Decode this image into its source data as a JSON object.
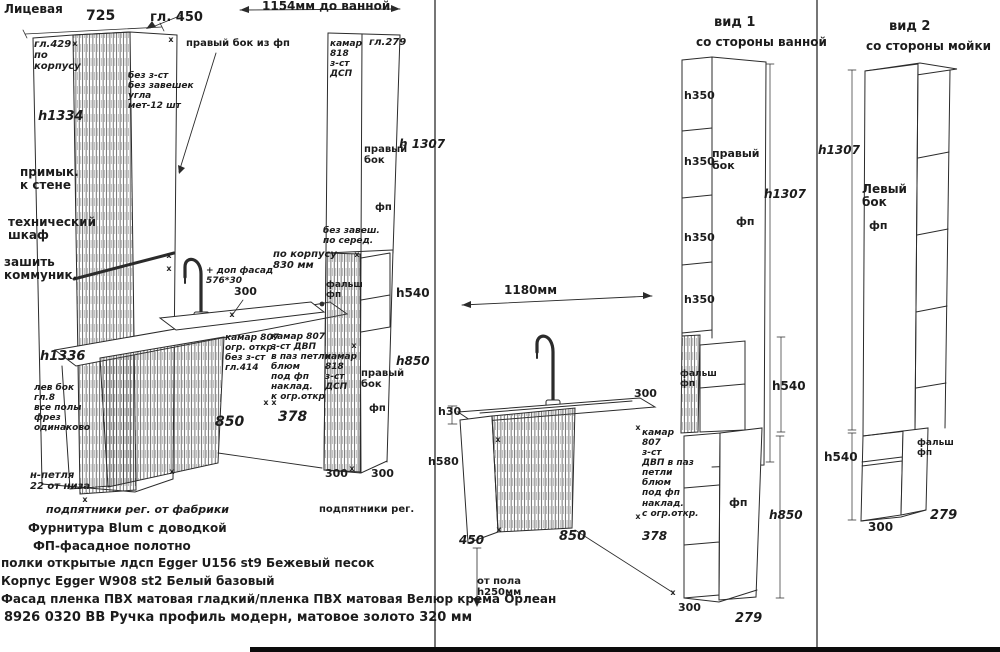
{
  "glyphs": {
    "x": "х"
  },
  "front_view": {
    "title": "Лицевая",
    "dim_width_top": "725",
    "dim_depth_top": "гл. 450",
    "gl429_note": "гл.429\nпо\nкорпусу",
    "h1334": "h1334",
    "no_back_note": "без з-ст\nбез завешек\nугла\nмет-12 шт",
    "right_side_callout": "правый  бок  из фп",
    "wall_note": "примык.\nк стене",
    "tech_note": "технический\nшкаф",
    "comm_note": "зашить\nкоммуник.",
    "h1336": "h1336",
    "left_side_note": "лев бок\nгл.8\nвсе полы\nфрез\nодинаково",
    "hinge_note": "н-петля\n22 от низа",
    "feet_note": "подпятники  рег.  от фабрики",
    "dim_to_bath": "1154мм до ванной",
    "kamar818_top": "камар\n818\nз-ст\nДСП",
    "gl279": "гл.279",
    "right_side_label": "правый\nбок",
    "h1307": "h 1307",
    "fp_upper": "фп",
    "no_hinge_note": "без завеш.\nпо  серед.",
    "po_korpusu": "по корпусу\n830  мм",
    "extra_facade": "+ доп фасад\n576*30",
    "dim300_top": "300",
    "falsh": "фальш\nфп",
    "h540": "h540",
    "kamar807_sink": "камар 807\nогр. откр.\nбез з-ст\nгл.414",
    "kamar807_mid": "камар 807\nз-ст  ДВП\nв паз петли\nблюм\nпод фп\nнаклад.\nк огр.откр",
    "kamar818_low": "камар\n818\nз-ст\nДСП",
    "right_side_label2": "правый\nбок",
    "h850": "h850",
    "fp_lower": "фп",
    "dim850": "850",
    "dim378": "378",
    "dim300_a": "300",
    "dim300_b": "300",
    "feet_note2": "подпятники  рег."
  },
  "specs": {
    "hardware": "Фурнитура Blum с доводкой",
    "fp_cloth": "ФП-фасадное  полотно",
    "shelves": "полки  открытые лдсп Egger U156 st9 Бежевый  песок",
    "body": "Корпус  Egger W908 st2 Белый  базовый",
    "facade": "Фасад пленка ПВХ матовая гладкий/пленка ПВХ матовая  Велюр крема  Орлеан",
    "handle": "8926 0320 ВВ Ручка профиль модерн, матовое золото 320 мм"
  },
  "view1": {
    "title": "вид 1",
    "subtitle": "со стороны  ванной",
    "h350_1": "h350",
    "h350_2": "h350",
    "h350_3": "h350",
    "h350_4": "h350",
    "right_side_label": "правый\nбок",
    "h1307": "h1307",
    "fp_upper": "фп",
    "dim1180": "1180мм",
    "h30": "h30",
    "dim300_top": "300",
    "h580": "h580",
    "kamar807": "камар\n807\nз-ст\nДВП в паз\nпетли\nблюм\nпод фп\nнаклад.\nс огр.откр.",
    "dim450": "450",
    "dim850": "850",
    "dim378": "378",
    "from_floor": "от пола\nh250мм",
    "falsh": "фальш\nфп",
    "h540": "h540",
    "fp_lower": "фп",
    "h850": "h850",
    "dim300_bottom": "300",
    "dim279": "279"
  },
  "view2": {
    "title": "вид 2",
    "subtitle": "со стороны  мойки",
    "h1307": "h1307",
    "left_side_label": "Левый\nбок",
    "fp": "фп",
    "h540": "h540",
    "falsh": "фальш\nфп",
    "dim300": "300",
    "dim279": "279"
  }
}
